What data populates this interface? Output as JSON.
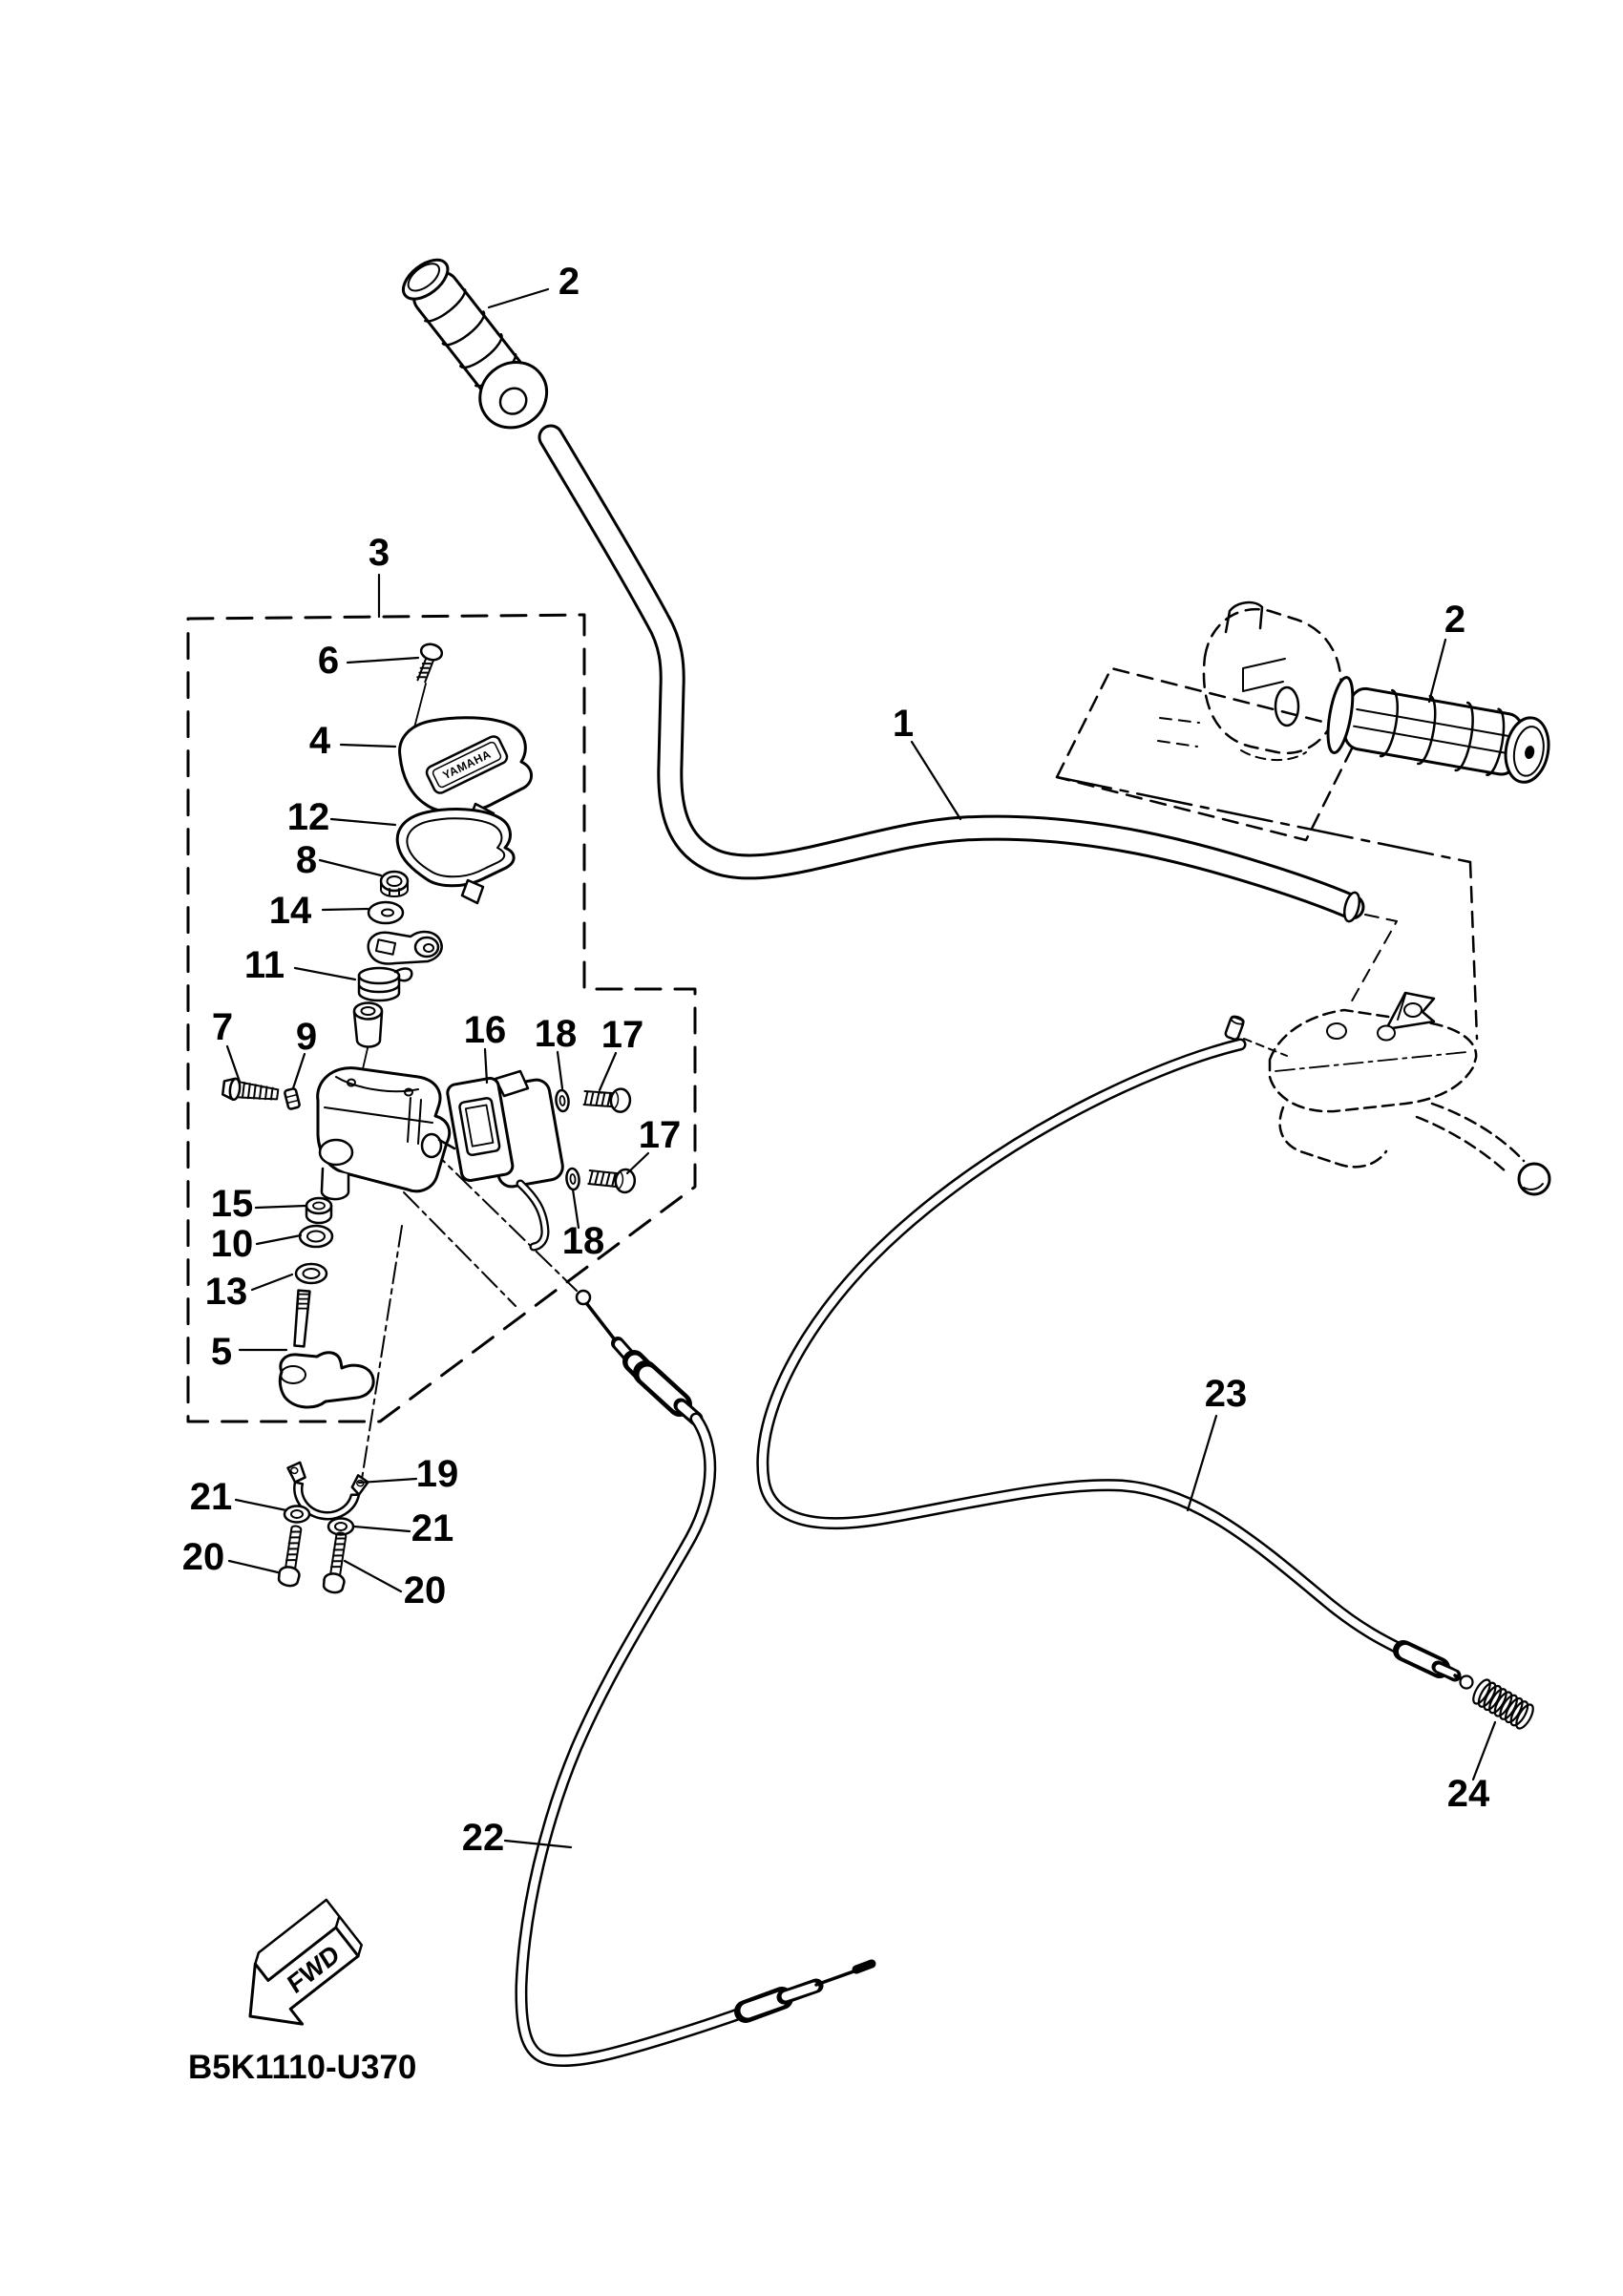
{
  "diagram": {
    "drawing_code": "B5K1110-U370",
    "fwd_label": "FWD",
    "brand_text": "YAMAHA",
    "background_color": "#ffffff",
    "line_color": "#000000",
    "callouts": [
      {
        "label": "1"
      },
      {
        "label": "2"
      },
      {
        "label": "2"
      },
      {
        "label": "3"
      },
      {
        "label": "4"
      },
      {
        "label": "5"
      },
      {
        "label": "6"
      },
      {
        "label": "7"
      },
      {
        "label": "8"
      },
      {
        "label": "9"
      },
      {
        "label": "10"
      },
      {
        "label": "11"
      },
      {
        "label": "12"
      },
      {
        "label": "13"
      },
      {
        "label": "14"
      },
      {
        "label": "15"
      },
      {
        "label": "16"
      },
      {
        "label": "17"
      },
      {
        "label": "17"
      },
      {
        "label": "18"
      },
      {
        "label": "18"
      },
      {
        "label": "19"
      },
      {
        "label": "20"
      },
      {
        "label": "20"
      },
      {
        "label": "21"
      },
      {
        "label": "21"
      },
      {
        "label": "22"
      },
      {
        "label": "23"
      },
      {
        "label": "24"
      }
    ]
  }
}
